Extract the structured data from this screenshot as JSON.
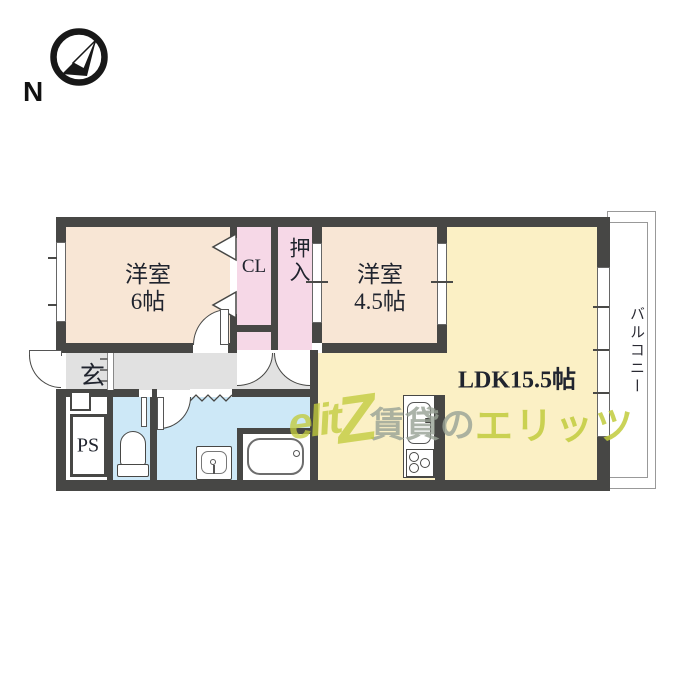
{
  "compass": {
    "label": "N",
    "icon": "compass-north-arrow"
  },
  "rooms": {
    "west_room_6": {
      "line1": "洋室",
      "line2": "6帖",
      "color": "#f8e6d5"
    },
    "closet": {
      "label": "CL",
      "color": "#f6d8e7"
    },
    "oshiire": {
      "label": "押入",
      "color": "#f6d8e7"
    },
    "west_room_45": {
      "line1": "洋室",
      "line2": "4.5帖",
      "color": "#f8e6d5"
    },
    "ldk": {
      "label": "LDK15.5帖",
      "color": "#fbf0c5"
    },
    "balcony": {
      "label": "バルコニー",
      "color": "#ffffff"
    },
    "genkan": {
      "label": "玄",
      "color": "#e1e1e1"
    },
    "pipe_space": {
      "label": "PS",
      "color": "#ffffff"
    },
    "sanitary_color": "#cde8f7"
  },
  "structure": {
    "wall_color": "#474745",
    "text_color": "#20242e"
  },
  "fixtures": [
    "toilet",
    "washbasin",
    "bathtub",
    "kitchen-sink",
    "stove-3-burner"
  ],
  "watermark": {
    "logo_part1": "elit",
    "logo_part2": "Z",
    "gray_text": "賃貸の",
    "green_text": "エリッツ",
    "gray_color": "#98a296",
    "green_color": "#c1cb3c"
  }
}
